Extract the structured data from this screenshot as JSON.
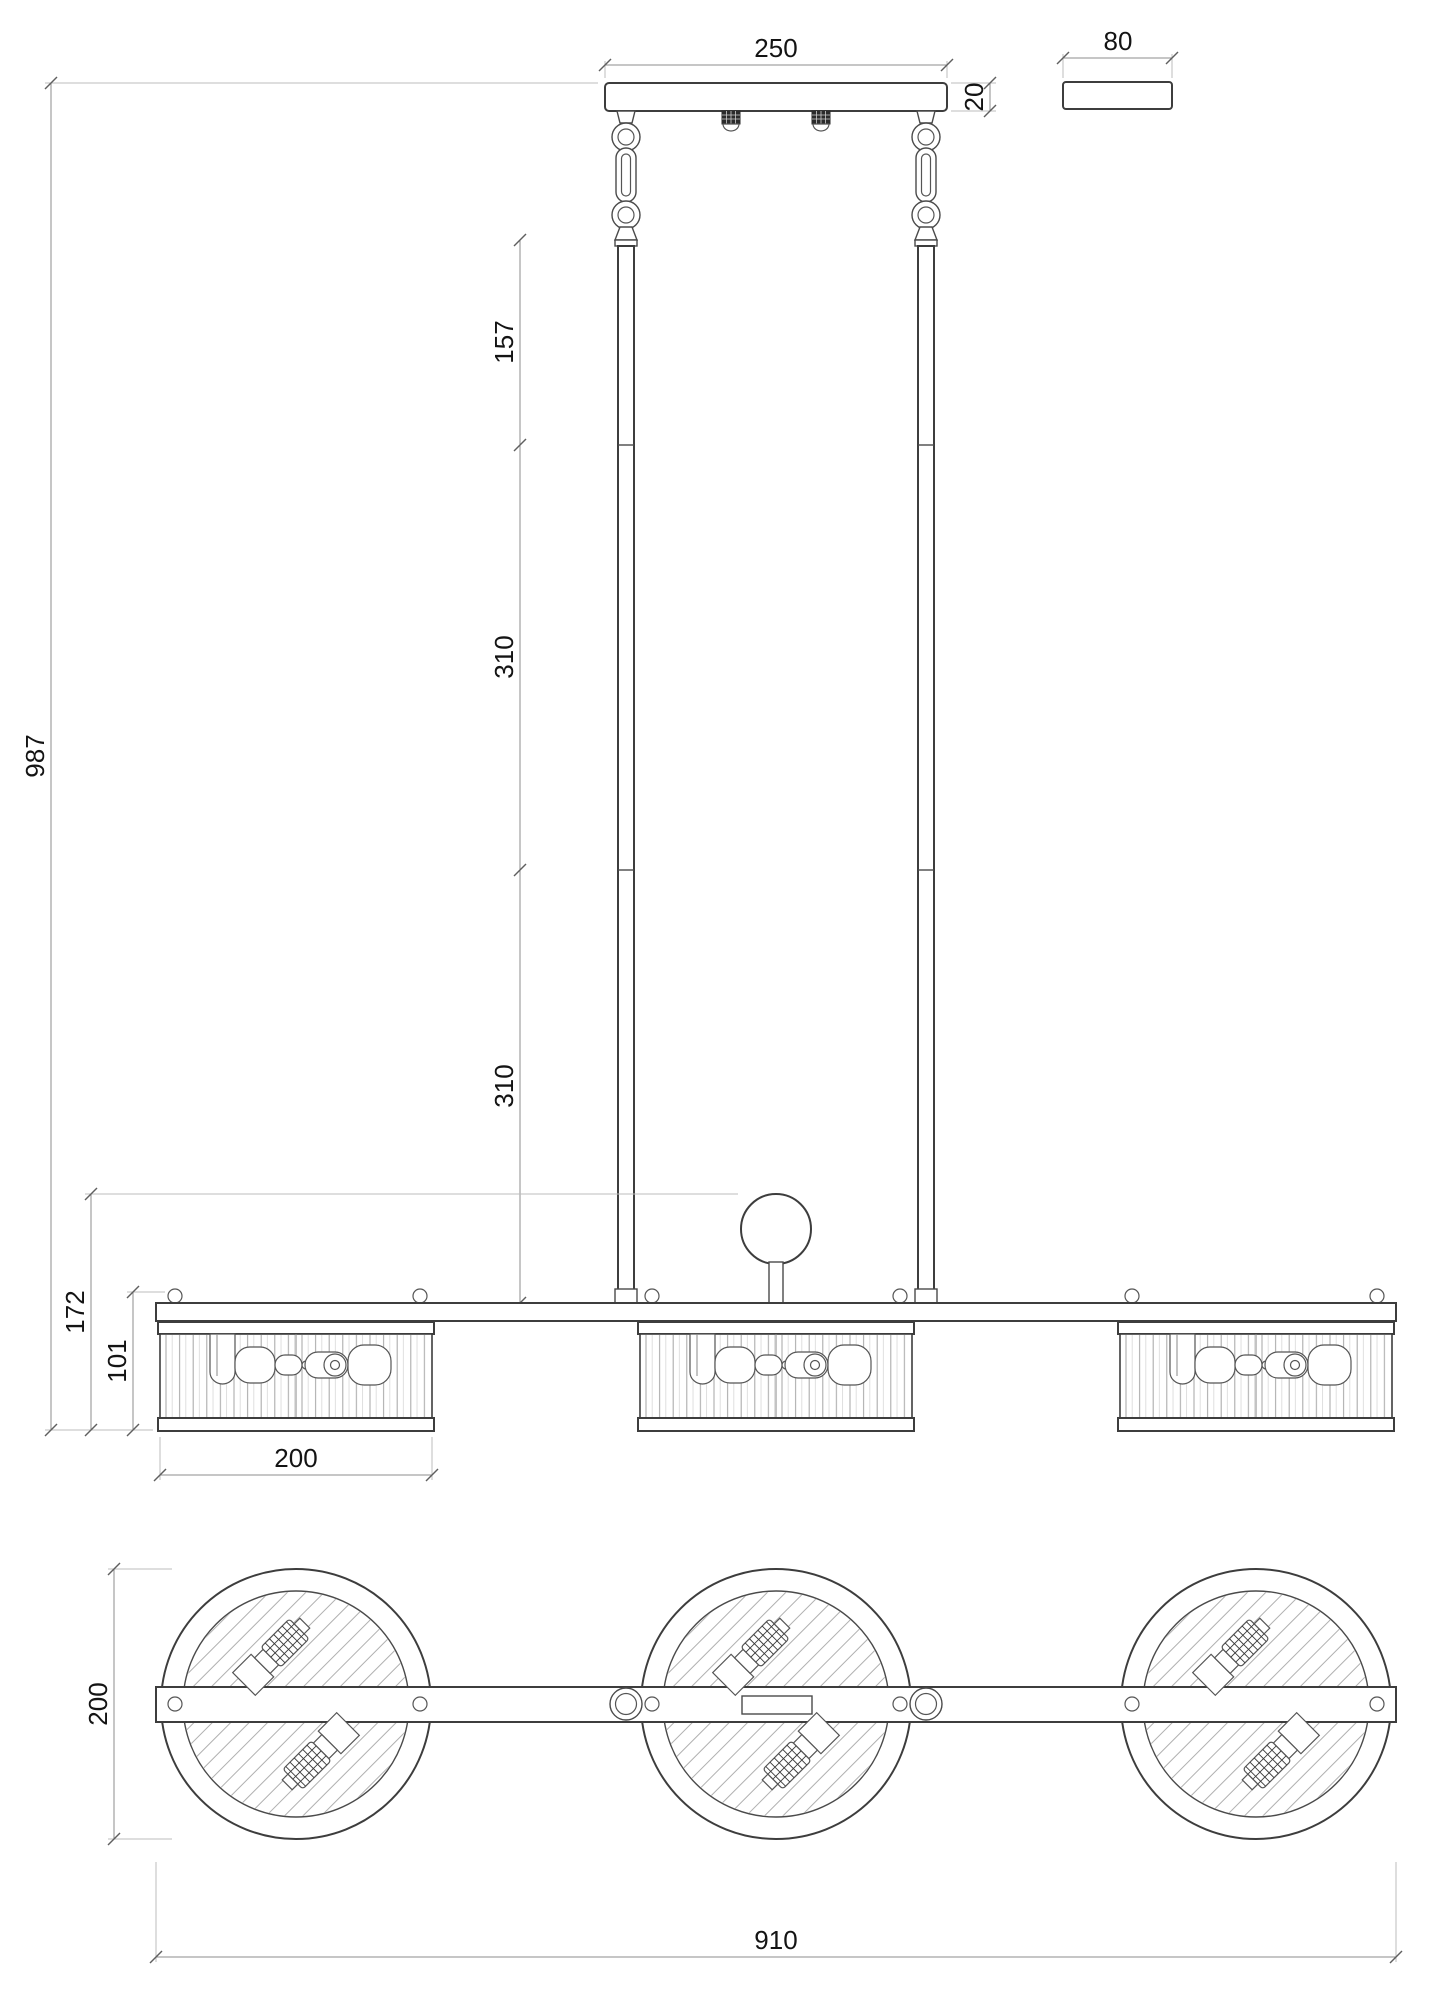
{
  "dimensions": {
    "canopy_width": "250",
    "canopy_thickness": "20",
    "canopy_side_width": "80",
    "suspension_upper_segment": "157",
    "suspension_middle_segment": "310",
    "suspension_lower_segment": "310",
    "overall_height": "987",
    "body_with_finial_height": "172",
    "shade_height": "101",
    "shade_width_front": "200",
    "shade_diameter_plan": "200",
    "overall_length": "910"
  }
}
